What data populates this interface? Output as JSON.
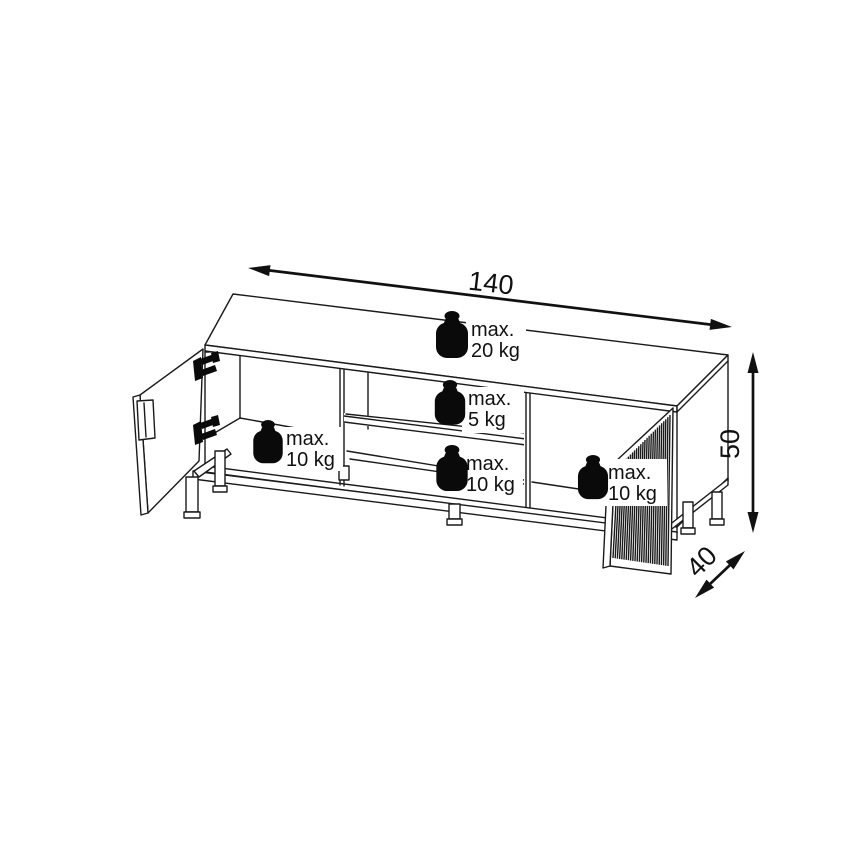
{
  "diagram": {
    "dimensions": {
      "width": {
        "value": "140"
      },
      "height": {
        "value": "50"
      },
      "depth": {
        "value": "40"
      }
    },
    "load_labels": [
      {
        "location": "top-surface",
        "line1": "max.",
        "line2": "20 kg"
      },
      {
        "location": "middle-shelf",
        "line1": "max.",
        "line2": "5 kg"
      },
      {
        "location": "left-compartment",
        "line1": "max.",
        "line2": "10 kg"
      },
      {
        "location": "middle-bottom",
        "line1": "max.",
        "line2": "10 kg"
      },
      {
        "location": "right-compartment",
        "line1": "max.",
        "line2": "10 kg"
      }
    ],
    "right_door": {
      "flute_count": 26
    },
    "colors": {
      "line": "#1a1a1a",
      "background": "#ffffff",
      "weight_icon": "#0a0a0a"
    }
  }
}
